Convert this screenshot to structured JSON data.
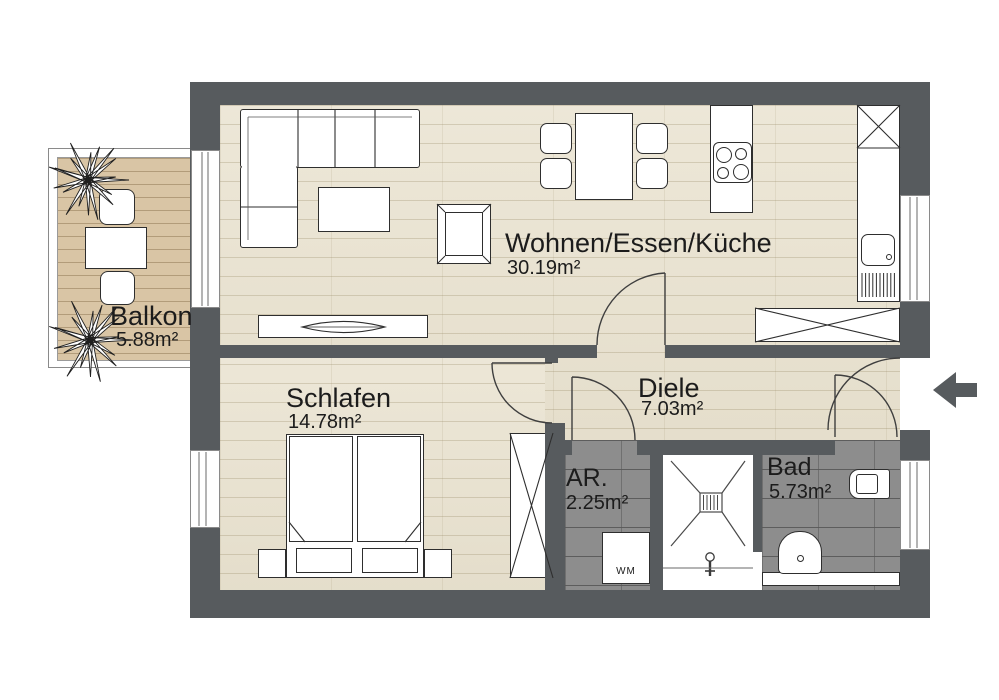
{
  "floor_plan": {
    "rooms": {
      "wohnen": {
        "name": "Wohnen/Essen/Küche",
        "area": "30.19m²"
      },
      "balkon": {
        "name": "Balkon",
        "area": "5.88m²"
      },
      "schlafen": {
        "name": "Schlafen",
        "area": "14.78m²"
      },
      "diele": {
        "name": "Diele",
        "area": "7.03m²"
      },
      "abstellraum": {
        "name": "AR.",
        "area": "2.25m²"
      },
      "bad": {
        "name": "Bad",
        "area": "5.73m²"
      }
    },
    "labels": {
      "washing_machine": "WM"
    },
    "icons": {
      "entrance_arrow": "left-arrow",
      "plant": "starburst",
      "cooktop": "four-burner-circles",
      "shower_drain": "hatched-square",
      "door_swing": "quarter-arc"
    },
    "colors": {
      "wall": "#575b5e",
      "wood_floor": "#e9e2cf",
      "balcony_deck": "#d9c5a5",
      "bath_tile": "#8d8d8d",
      "text": "#1c1c1c"
    }
  }
}
